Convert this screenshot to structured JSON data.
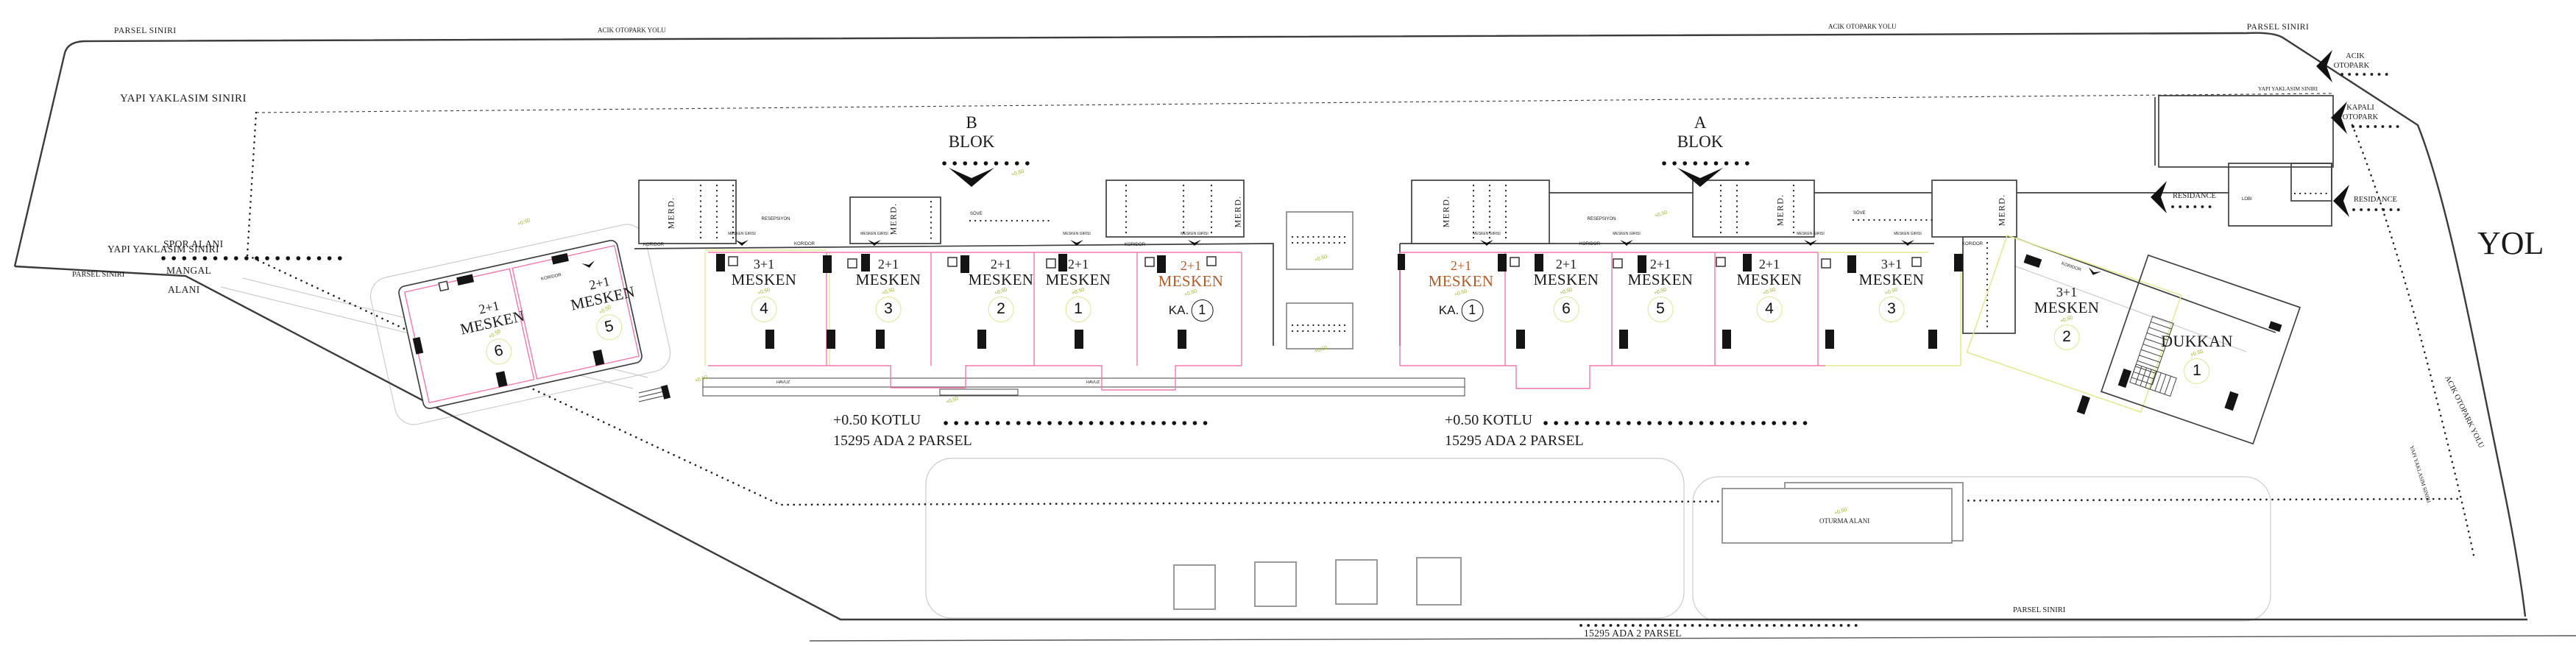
{
  "boundaries": {
    "parsel": "PARSEL SINIRI",
    "yaklasim": "YAPI YAKLASIM SINIRI"
  },
  "roads": {
    "otopark_yolu": "ACIK OTOPARK YOLU",
    "yol": "YOL"
  },
  "blocks": {
    "b_letter": "B",
    "a_letter": "A",
    "word": "BLOK"
  },
  "areas": {
    "spor": "SPOR ALANI",
    "mangal_1": "MANGAL",
    "mangal_2": "ALANI",
    "oturma": "OTURMA ALANI",
    "havuz": "HAVUZ",
    "lobi": "LOBI"
  },
  "parking": {
    "acik_1": "ACIK",
    "acik_2": "OTOPARK",
    "kapali_1": "KAPALI",
    "kapali_2": "OTOPARK",
    "residance": "RESIDANCE"
  },
  "labels": {
    "merd": "MERD.",
    "koridor": "KORIDOR",
    "resepsiyon": "RESEPSIYON",
    "sove": "SÖVE",
    "giris": "MESKEN GIRISI",
    "level": "+0.50",
    "ka_prefix": "KA."
  },
  "site": {
    "kotlu": "+0.50 KOTLU",
    "ada_parsel": "15295 ADA 2 PARSEL",
    "ada_parsel_bottom": "15295 ADA 2 PARSEL"
  },
  "units_b": [
    {
      "type": "2+1",
      "word": "MESKEN",
      "no": "6"
    },
    {
      "type": "2+1",
      "word": "MESKEN",
      "no": "5"
    },
    {
      "type": "3+1",
      "word": "MESKEN",
      "no": "4"
    },
    {
      "type": "2+1",
      "word": "MESKEN",
      "no": "3"
    },
    {
      "type": "2+1",
      "word": "MESKEN",
      "no": "2"
    },
    {
      "type": "2+1",
      "word": "MESKEN",
      "no": "1"
    },
    {
      "type": "2+1",
      "word": "MESKEN",
      "no": "1"
    }
  ],
  "units_a": [
    {
      "type": "2+1",
      "word": "MESKEN",
      "no": "1"
    },
    {
      "type": "2+1",
      "word": "MESKEN",
      "no": "6"
    },
    {
      "type": "2+1",
      "word": "MESKEN",
      "no": "5"
    },
    {
      "type": "2+1",
      "word": "MESKEN",
      "no": "4"
    },
    {
      "type": "3+1",
      "word": "MESKEN",
      "no": "3"
    },
    {
      "type": "3+1",
      "word": "MESKEN",
      "no": "2"
    }
  ],
  "dukkan": {
    "name": "DUKKAN",
    "no": "1"
  },
  "colors": {
    "line": "#3b3b3b",
    "unit_line": "#f277ad",
    "alt_line": "#e3ea8e",
    "level_text": "#9cb520",
    "orange_text": "#b55a26"
  }
}
